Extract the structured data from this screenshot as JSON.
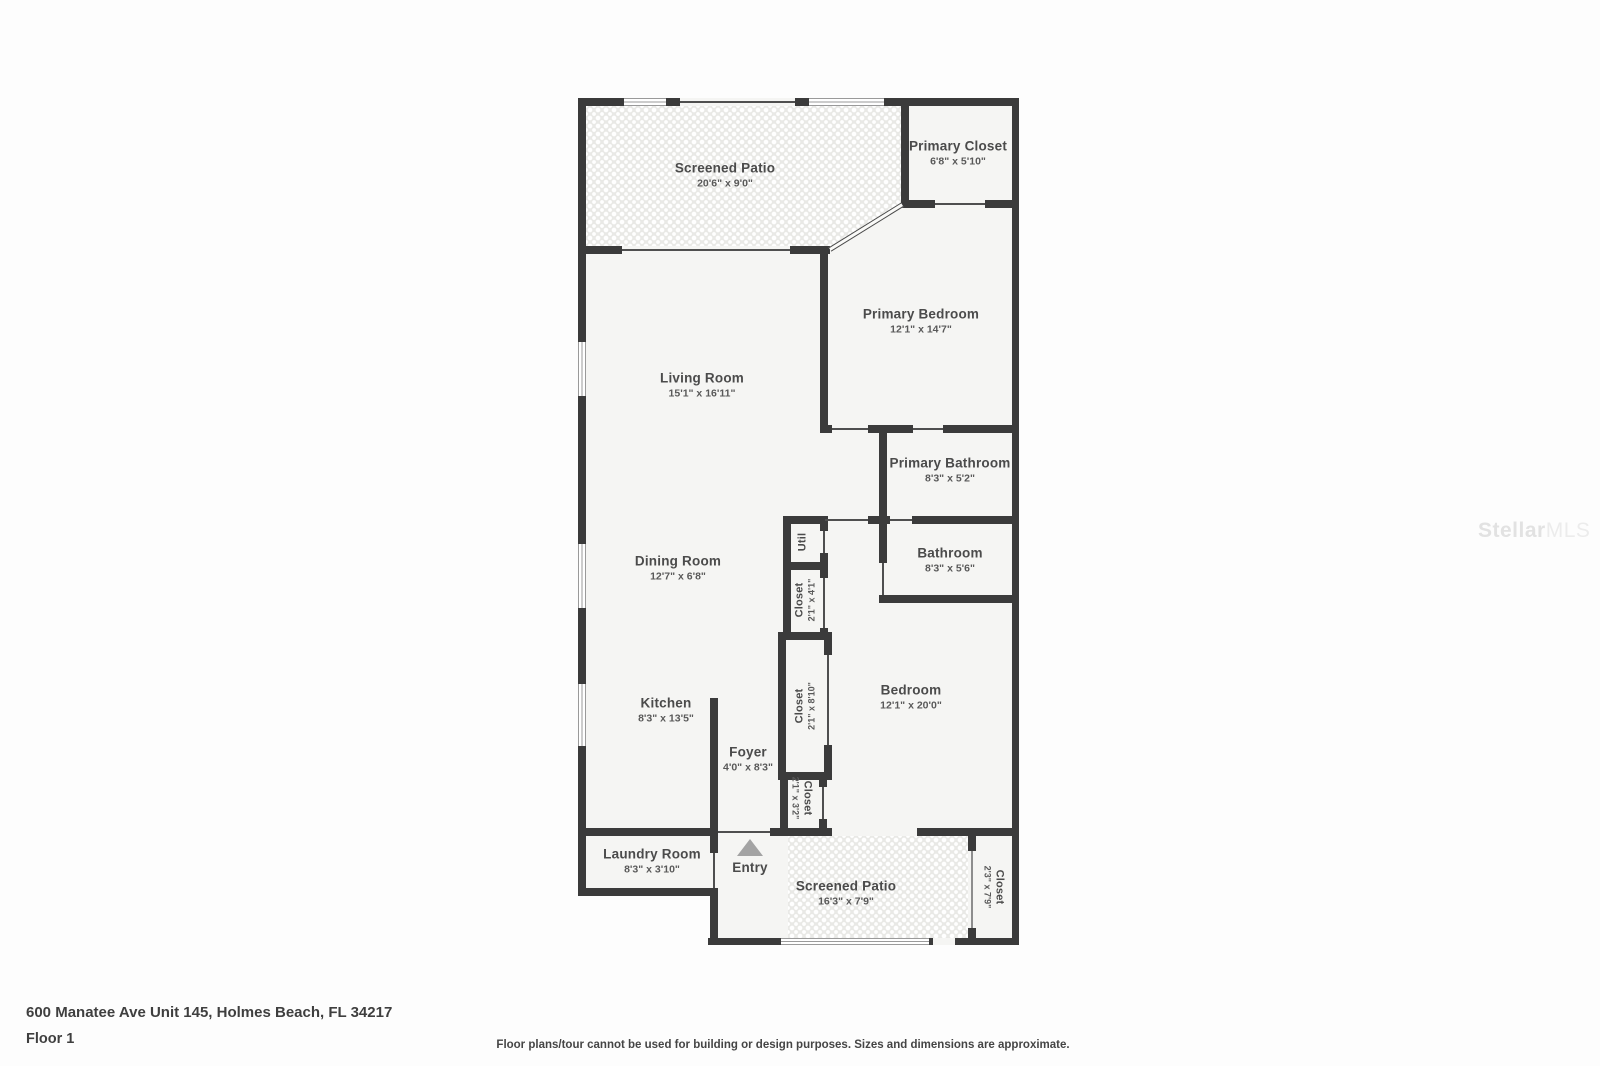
{
  "watermark": {
    "brand1": "Stellar",
    "brand2": "MLS"
  },
  "footer": {
    "address": "600 Manatee Ave Unit 145, Holmes Beach, FL 34217",
    "floor": "Floor 1",
    "disclaimer": "Floor plans/tour cannot be used for building or design purposes. Sizes and dimensions are approximate."
  },
  "rooms": {
    "screened_patio_top": {
      "name": "Screened Patio",
      "dims": "20'6\" x 9'0\""
    },
    "primary_closet": {
      "name": "Primary Closet",
      "dims": "6'8\" x 5'10\""
    },
    "primary_bedroom": {
      "name": "Primary Bedroom",
      "dims": "12'1\" x 14'7\""
    },
    "living_room": {
      "name": "Living Room",
      "dims": "15'1\" x 16'11\""
    },
    "primary_bathroom": {
      "name": "Primary Bathroom",
      "dims": "8'3\" x 5'2\""
    },
    "bathroom": {
      "name": "Bathroom",
      "dims": "8'3\" x 5'6\""
    },
    "dining_room": {
      "name": "Dining Room",
      "dims": "12'7\" x 6'8\""
    },
    "util": {
      "name": "Util"
    },
    "closet_hall_small": {
      "name": "Closet",
      "dims": "2'1\" x 4'1\""
    },
    "closet_hall_tall": {
      "name": "Closet",
      "dims": "2'1\" x 8'10\""
    },
    "bedroom": {
      "name": "Bedroom",
      "dims": "12'1\" x 20'0\""
    },
    "kitchen": {
      "name": "Kitchen",
      "dims": "8'3\" x 13'5\""
    },
    "foyer": {
      "name": "Foyer",
      "dims": "4'0\" x 8'3\""
    },
    "closet_foyer": {
      "name": "Closet",
      "dims": "2'1\" x 3'2\""
    },
    "laundry_room": {
      "name": "Laundry Room",
      "dims": "8'3\" x 3'10\""
    },
    "entry": {
      "name": "Entry"
    },
    "screened_patio_bottom": {
      "name": "Screened Patio",
      "dims": "16'3\" x 7'9\""
    },
    "closet_patio": {
      "name": "Closet",
      "dims": "2'3\" x 7'9\""
    }
  }
}
